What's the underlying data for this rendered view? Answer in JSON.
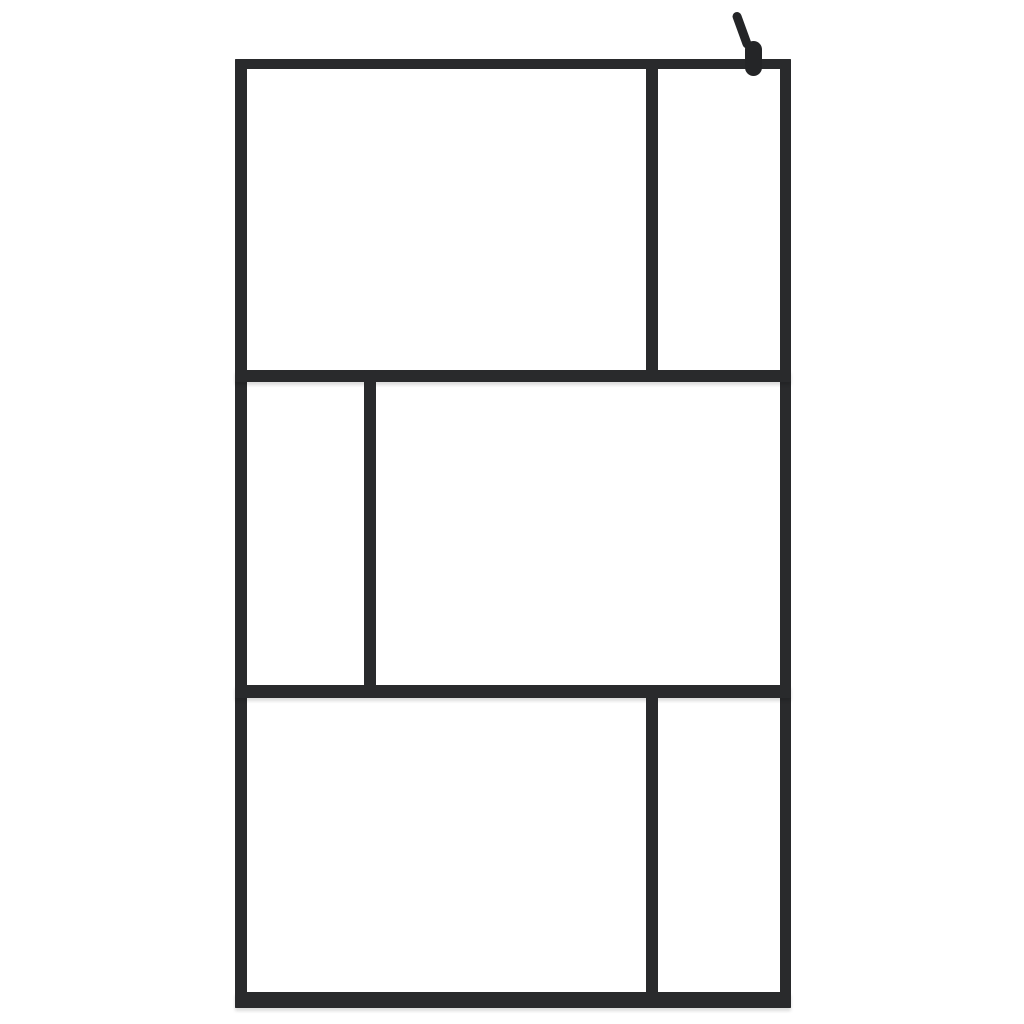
{
  "scene": {
    "description": "Product photo of a walk-in shower screen: clear glass with a black aluminium frame forming an abstract grid of six panes, with a black wall-mount support bracket at the top right corner",
    "background_color": "#ffffff",
    "glass_color": "#ffffff",
    "frame_color": "#292a2c",
    "bracket_color": "#242527",
    "shadow_color": "rgba(0,0,0,0.14)"
  },
  "frame": {
    "x": 235,
    "y": 59,
    "width": 556,
    "height": 949,
    "bars": [
      {
        "name": "frame-top-rail",
        "x": 0,
        "y": 0,
        "w": 556,
        "h": 10,
        "shadow": false
      },
      {
        "name": "frame-bottom-rail",
        "x": 0,
        "y": 933,
        "w": 556,
        "h": 16,
        "shadow": true
      },
      {
        "name": "frame-left-stile",
        "x": 0,
        "y": 0,
        "w": 12,
        "h": 949,
        "shadow": false
      },
      {
        "name": "frame-right-stile",
        "x": 545,
        "y": 0,
        "w": 11,
        "h": 949,
        "shadow": false
      },
      {
        "name": "frame-upper-crossbar",
        "x": 0,
        "y": 311,
        "w": 556,
        "h": 12,
        "shadow": true
      },
      {
        "name": "frame-lower-crossbar",
        "x": 0,
        "y": 626,
        "w": 556,
        "h": 13,
        "shadow": true
      },
      {
        "name": "frame-top-mullion",
        "x": 411,
        "y": 0,
        "w": 12,
        "h": 323,
        "shadow": false
      },
      {
        "name": "frame-middle-mullion",
        "x": 129,
        "y": 311,
        "w": 12,
        "h": 328,
        "shadow": false
      },
      {
        "name": "frame-bottom-mullion",
        "x": 411,
        "y": 626,
        "w": 12,
        "h": 323,
        "shadow": false
      }
    ],
    "panels": [
      {
        "name": "glass-pane-top-left",
        "x": 12,
        "y": 10,
        "w": 399,
        "h": 301
      },
      {
        "name": "glass-pane-top-right",
        "x": 423,
        "y": 10,
        "w": 122,
        "h": 301
      },
      {
        "name": "glass-pane-middle-left",
        "x": 12,
        "y": 323,
        "w": 117,
        "h": 303
      },
      {
        "name": "glass-pane-middle-right",
        "x": 141,
        "y": 323,
        "w": 404,
        "h": 303
      },
      {
        "name": "glass-pane-bottom-left",
        "x": 12,
        "y": 639,
        "w": 399,
        "h": 294
      },
      {
        "name": "glass-pane-bottom-right",
        "x": 423,
        "y": 639,
        "w": 122,
        "h": 294
      }
    ]
  },
  "bracket": {
    "arm": {
      "x": 744,
      "y": 10,
      "w": 9,
      "h": 38,
      "rotate_deg": -20
    },
    "base": {
      "x": 745,
      "y": 41,
      "w": 17,
      "h": 35
    }
  }
}
